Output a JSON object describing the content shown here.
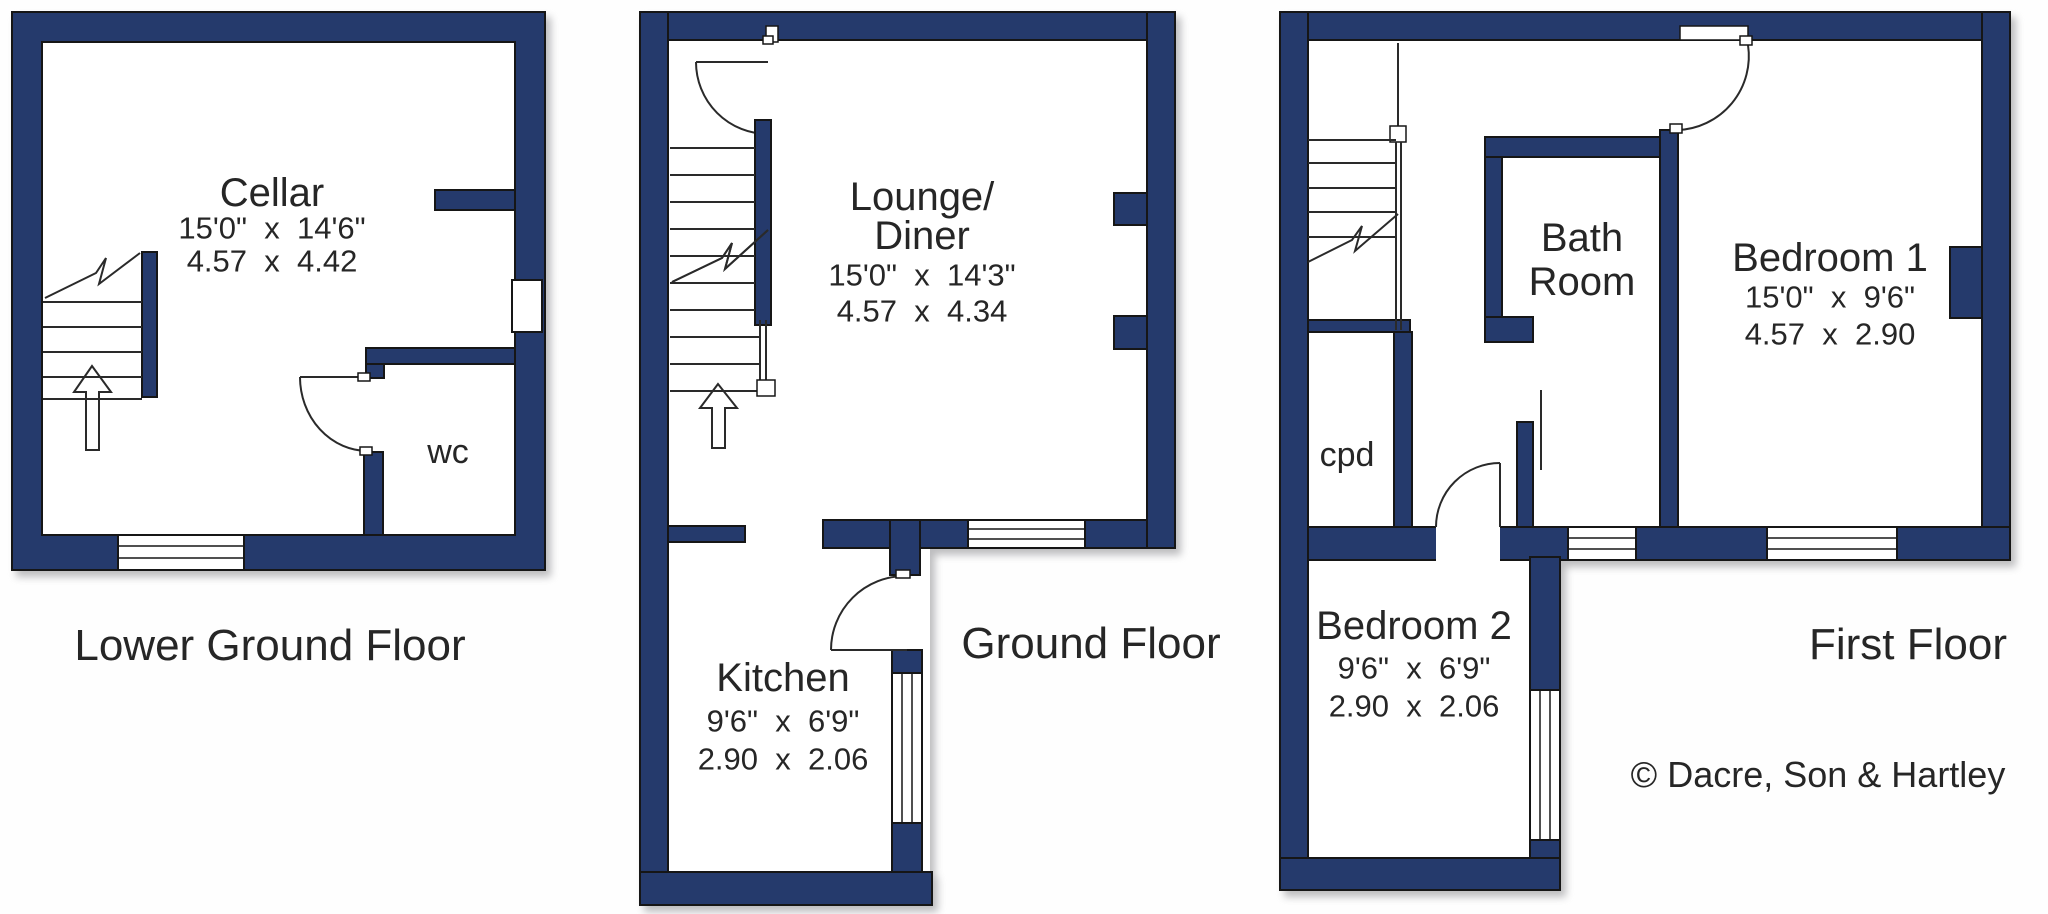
{
  "title": "Property floor plans",
  "colors": {
    "wall_navy": "#253a6c",
    "outline": "#161616",
    "text": "#262626",
    "background": "#fefefe"
  },
  "plans": [
    {
      "id": "lower-ground-floor",
      "floor_label": "Lower Ground Floor",
      "rooms": [
        {
          "name": "Cellar",
          "imperial": "15'0\"  x  14'6\"",
          "metric": "4.57  x  4.42"
        },
        {
          "name": "wc"
        }
      ]
    },
    {
      "id": "ground-floor",
      "floor_label": "Ground Floor",
      "rooms": [
        {
          "name": "Lounge/",
          "name_line2": "Diner",
          "imperial": "15'0\"  x  14'3\"",
          "metric": "4.57  x  4.34"
        },
        {
          "name": "Kitchen",
          "imperial": "9'6\"  x  6'9\"",
          "metric": "2.90  x  2.06"
        }
      ]
    },
    {
      "id": "first-floor",
      "floor_label": "First Floor",
      "rooms": [
        {
          "name": "Bath",
          "name_line2": "Room"
        },
        {
          "name": "Bedroom 1",
          "imperial": "15'0\"  x  9'6\"",
          "metric": "4.57  x  2.90"
        },
        {
          "name": "cpd"
        },
        {
          "name": "Bedroom 2",
          "imperial": "9'6\"  x  6'9\"",
          "metric": "2.90  x  2.06"
        }
      ]
    }
  ],
  "copyright": "© Dacre, Son & Hartley"
}
